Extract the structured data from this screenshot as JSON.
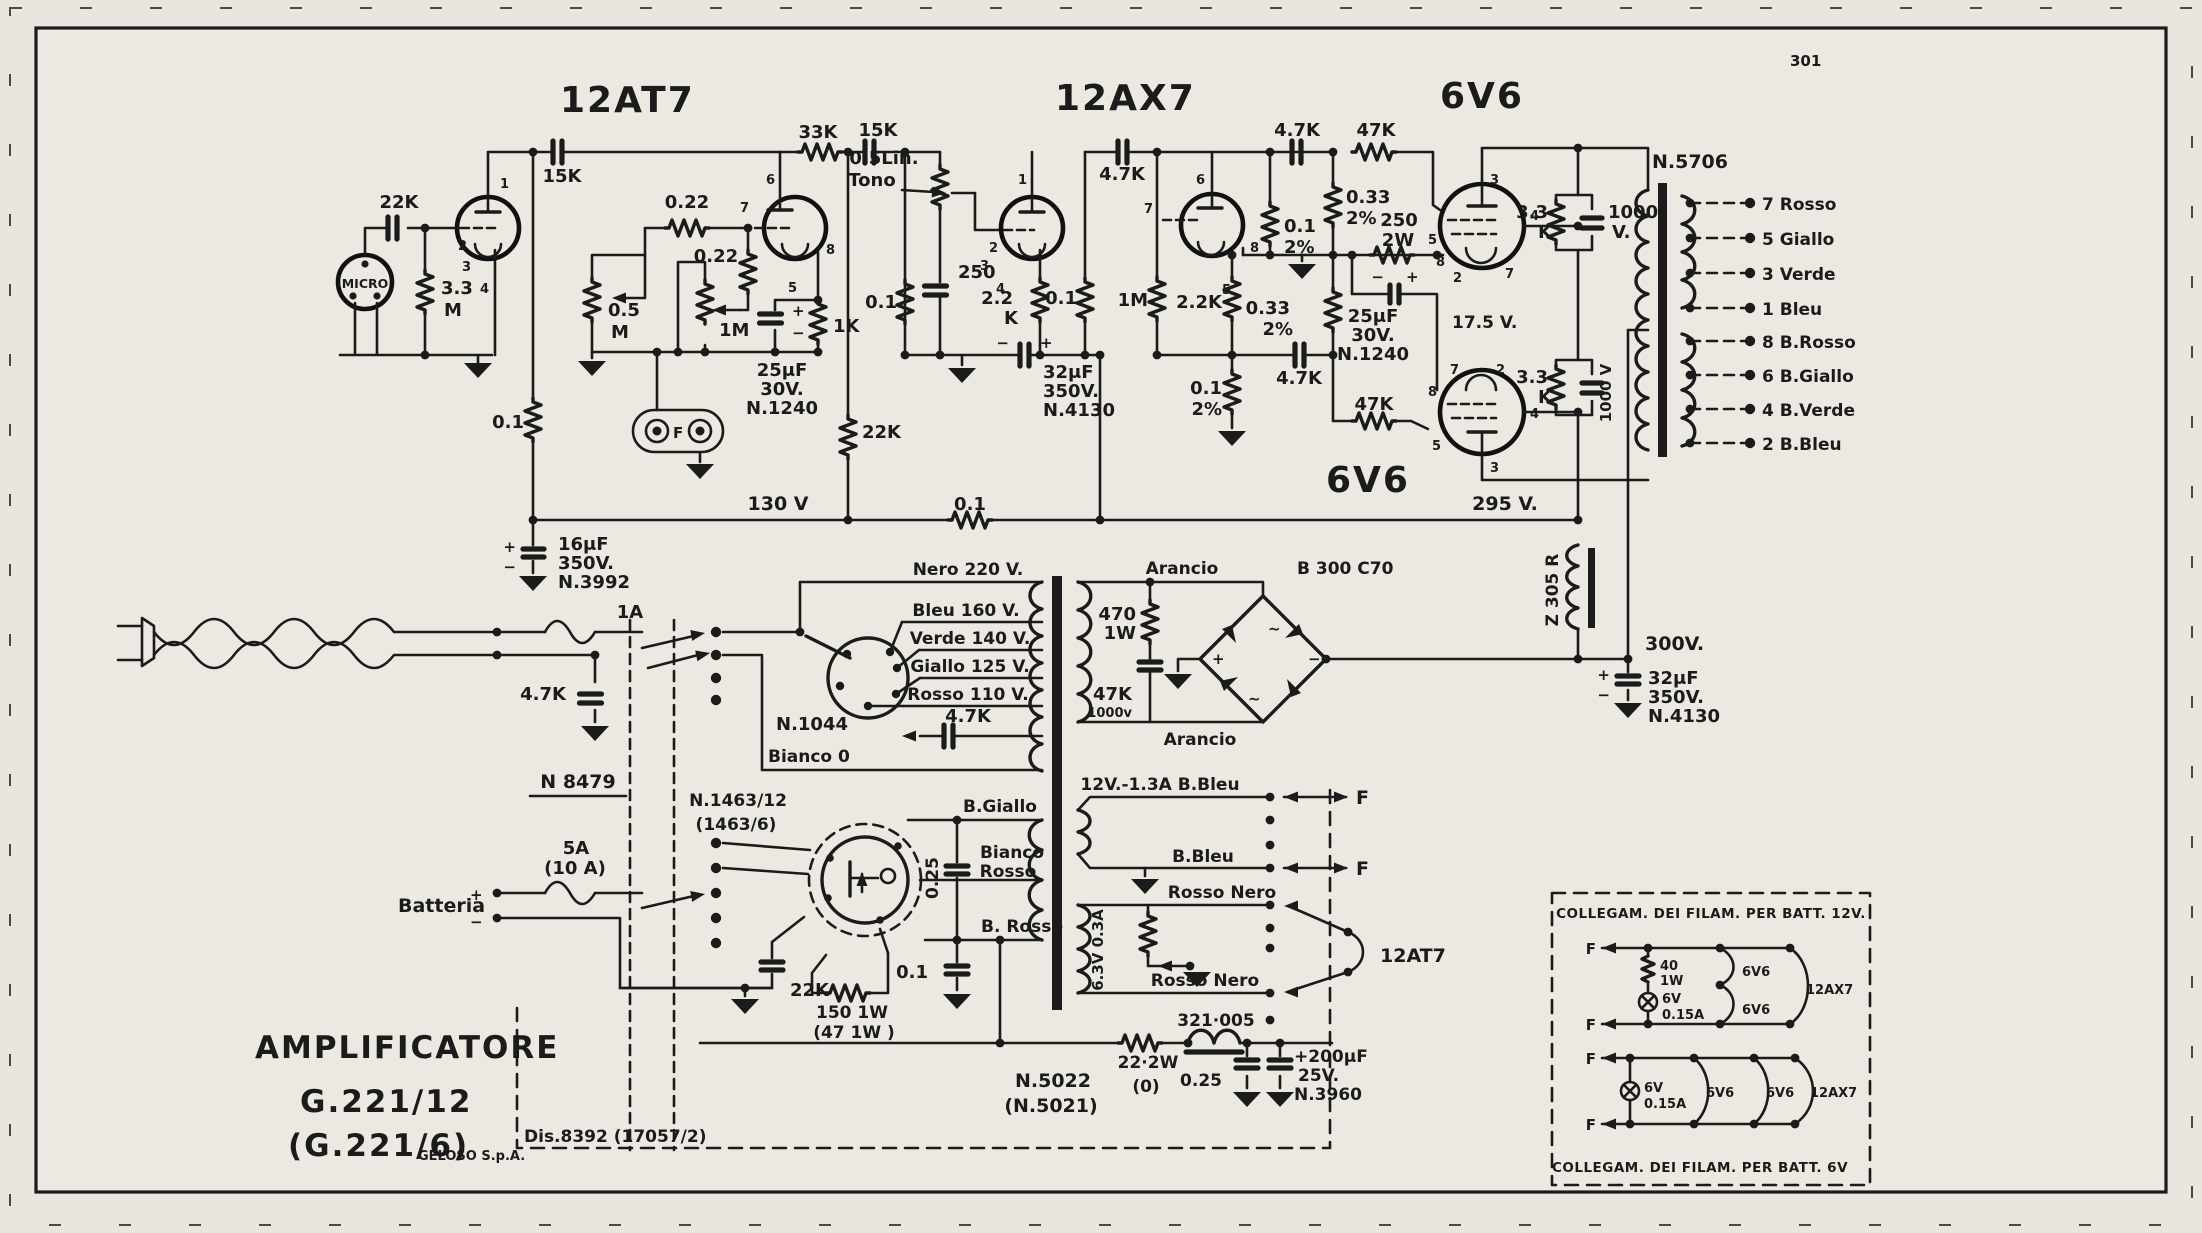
{
  "page": {
    "number": "301"
  },
  "tubes": {
    "v1": "12AT7",
    "v2": "12AX7",
    "v3": "6V6",
    "v4": "6V6",
    "bracket": "12AT7"
  },
  "pins": [
    "1",
    "2",
    "3",
    "4",
    "5",
    "6",
    "7",
    "8"
  ],
  "input": {
    "mic": "MICRO",
    "c_in": "22K",
    "r_grid_a": "3.3",
    "r_grid_b": "M",
    "c_plate": "15K",
    "r_feed": "0.1"
  },
  "stage2": {
    "r33k": "33K",
    "c15k": "15K",
    "r022a": "0.22",
    "r022b": "0.22",
    "pot05a": "0.5",
    "pot05b": "M",
    "pot1m": "1M",
    "r1k": "1K",
    "c25a1": "25μF",
    "c25a2": "30V.",
    "c25a3": "N.1240",
    "c25_plus": "+",
    "c25_minus": "−",
    "jack_f": "F",
    "r22k": "22K"
  },
  "tone": {
    "pot_a": "0.5Lin.",
    "pot_b": "Tono",
    "c250": "250",
    "r01": "0.1"
  },
  "stage3": {
    "r22a": "2.2",
    "r22b": "K",
    "r01": "0.1",
    "c32a": "32μF",
    "c32b": "350V.",
    "c32c": "N.4130",
    "minus": "−",
    "plus": "+"
  },
  "inverter": {
    "c47k": "4.7K",
    "r1m": "1M",
    "r22k": "2.2K",
    "r01a": "0.1",
    "r01a2": "2%",
    "r033a": "0.33",
    "r033a2": "2%",
    "c47k_top": "4.7K",
    "r47k_top": "47K",
    "r033b": "0.33",
    "r033b2": "2%",
    "r01b": "0.1",
    "r01b2": "2%",
    "c47k_lo": "4.7K",
    "r47k_lo": "47K",
    "r250a": "250",
    "r250b": "2W",
    "c25b1": "25μF",
    "c25b2": "30V.",
    "c25b3": "N.1240",
    "c25_minus": "−",
    "c25_plus": "+",
    "v175": "17.5 V."
  },
  "output_stage": {
    "r33a": "3.3",
    "r33a2": "K",
    "c1000a1": "1000",
    "c1000a2": "V.",
    "r33b": "3.3",
    "r33b2": "K",
    "c1000b": "1000 V",
    "n5706": "N.5706"
  },
  "out_terminals": [
    "7 Rosso",
    "5 Giallo",
    "3 Verde",
    "1 Bleu",
    "8 B.Rosso",
    "6 B.Giallo",
    "4 B.Verde",
    "2 B.Bleu"
  ],
  "rails": {
    "v130": "130 V",
    "r01": "0.1",
    "v295": "295 V.",
    "v300": "300V.",
    "z305": "Z 305 R",
    "c32a": "32μF",
    "c32b": "350V.",
    "c32c": "N.4130",
    "c32_plus": "+",
    "c32_minus": "−",
    "c16a": "16μF",
    "c16b": "350V.",
    "c16c": "N.3992",
    "c16_plus": "+",
    "c16_minus": "−"
  },
  "mains": {
    "fuse": "1A",
    "c47k": "4.7K",
    "n8479": "N 8479",
    "bianco": "Bianco 0",
    "n1044": "N.1044",
    "c47k_sel": "4.7K",
    "taps": [
      "Nero 220 V.",
      "Bleu  160 V.",
      "Verde 140 V.",
      "Giallo 125 V.",
      "Rosso 110 V."
    ]
  },
  "rectifier": {
    "arancio_top": "Arancio",
    "model": "B 300 C70",
    "r470a": "470",
    "r470b": "1W",
    "c47k": "47K",
    "c47k_v": "1000v",
    "arancio_bot": "Arancio",
    "plus": "+",
    "minus": "−",
    "ac1": "~",
    "ac2": "~"
  },
  "battery": {
    "label": "Batteria",
    "plus": "+",
    "minus": "−",
    "fuse_a": "5A",
    "fuse_b": "(10 A)",
    "n1463a": "N.1463/12",
    "n1463b": "(1463/6)",
    "c22k": "22K",
    "r150a": "150 1W",
    "r150b": "(47 1W )"
  },
  "vib": {
    "c025": "0.25",
    "bgiallo": "B.Giallo",
    "biancoa": "Bianco",
    "biancob": "Rosso",
    "brosso": "B. Rosso",
    "c01": "0.1",
    "w12": "12V.-1.3A  B.Bleu",
    "bbleu": "B.Bleu",
    "rn1": "Rosso Nero",
    "rn2": "Rosso Nero",
    "w63": "6.3V 0.3A",
    "f1": "F",
    "f2": "F",
    "choke": "321·005",
    "r22a": "22·2W",
    "r22b": "(0)",
    "c025b": "0.25",
    "c200a": "+200μF",
    "c200b": "25V.",
    "c200c": "N.3960",
    "n5022a": "N.5022",
    "n5022b": "(N.5021)",
    "dis": "Dis.8392 (17057/2)"
  },
  "filaments": {
    "t12": "COLLEGAM. DEI FILAM. PER BATT. 12V.",
    "t6": "COLLEGAM. DEI FILAM. PER BATT. 6V",
    "f": "F",
    "r40a": "40",
    "r40b": "1W",
    "l1a": "6V",
    "l1b": "0.15A",
    "l2a": "6V",
    "l2b": "0.15A",
    "a1": "6V6",
    "a2": "6V6",
    "a3": "12AX7",
    "b1": "6V6",
    "b2": "6V6",
    "b3": "12AX7"
  },
  "title_block": {
    "l1": "AMPLIFICATORE",
    "l2": "G.221/12",
    "l3": "(G.221/6)",
    "company": "GELOSO  S.p.A."
  }
}
